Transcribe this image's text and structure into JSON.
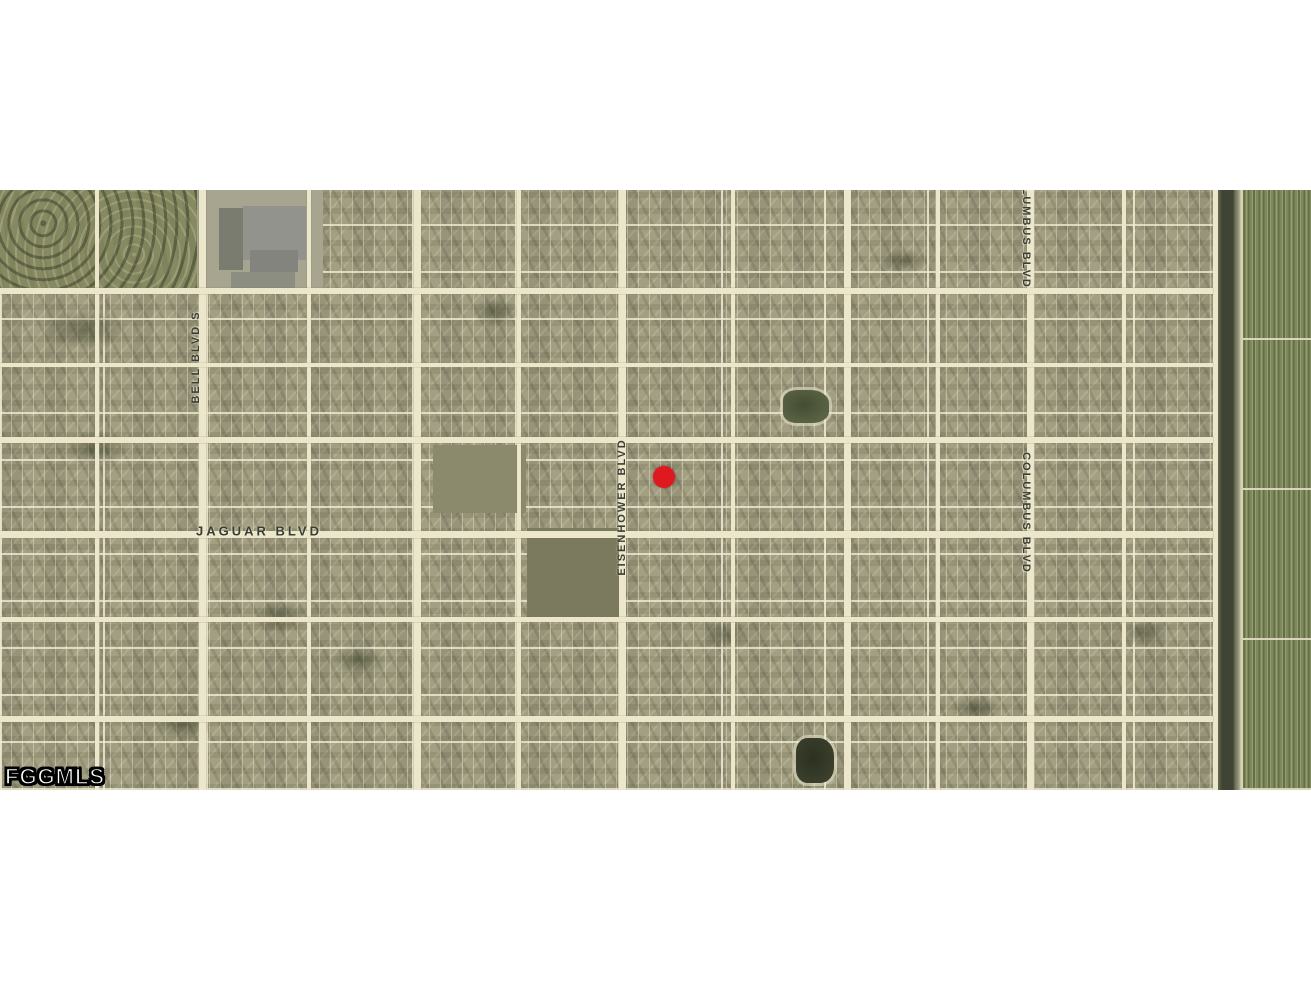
{
  "watermark": {
    "text": "FGGMLS",
    "x": 5,
    "y": 574
  },
  "marker": {
    "x": 664,
    "y": 287,
    "diameter": 22,
    "color": "#de1a20"
  },
  "map": {
    "top": 190,
    "height": 600,
    "width": 1311,
    "colors": {
      "base": "#a39f83",
      "road": "#ece7cb",
      "label": "#3b3d30",
      "canal_water": "#3f4433",
      "farmland": "#7e8a5b"
    },
    "street_labels": [
      {
        "text": "BELL BLVD S",
        "x": 196,
        "y": 167,
        "orientation": "vertical-up"
      },
      {
        "text": "JAGUAR BLVD",
        "x": 259,
        "y": 341,
        "orientation": "horizontal"
      },
      {
        "text": "EISENHOWER BLVD",
        "x": 622,
        "y": 317,
        "orientation": "vertical-up"
      },
      {
        "text": "COLUMBUS BLVD",
        "x": 1026,
        "y": 38,
        "orientation": "vertical-down"
      },
      {
        "text": "COLUMBUS BLVD",
        "x": 1026,
        "y": 323,
        "orientation": "vertical-down"
      }
    ],
    "vertical_roads": [
      {
        "x": 199,
        "w": 7
      },
      {
        "x": 414,
        "w": 7
      },
      {
        "x": 619,
        "w": 7
      },
      {
        "x": 844,
        "w": 7
      },
      {
        "x": 1027,
        "w": 7
      },
      {
        "x": 1213,
        "w": 5
      },
      {
        "x": 95,
        "w": 4
      },
      {
        "x": 307,
        "w": 4
      },
      {
        "x": 517,
        "w": 4
      },
      {
        "x": 731,
        "w": 4
      },
      {
        "x": 936,
        "w": 4
      },
      {
        "x": 1122,
        "w": 4
      }
    ],
    "horizontal_roads": [
      {
        "y": 98,
        "w": 6
      },
      {
        "y": 173,
        "w": 4
      },
      {
        "y": 247,
        "w": 6
      },
      {
        "y": 341,
        "w": 7
      },
      {
        "y": 427,
        "w": 5
      },
      {
        "y": 526,
        "w": 6
      }
    ],
    "areas": [
      {
        "name": "nature-preserve",
        "kind": "nature",
        "x": 0,
        "y": 0,
        "w": 197,
        "h": 104
      },
      {
        "name": "school-site",
        "kind": "plain",
        "x": 197,
        "y": 0,
        "w": 126,
        "h": 100,
        "color": "#a7a48f"
      },
      {
        "name": "school-parking",
        "kind": "plain",
        "x": 219,
        "y": 18,
        "w": 24,
        "h": 62,
        "color": "#797c6e"
      },
      {
        "name": "school-building",
        "kind": "plain",
        "x": 243,
        "y": 16,
        "w": 63,
        "h": 54,
        "color": "#92938d"
      },
      {
        "name": "school-building-annex",
        "kind": "plain",
        "x": 250,
        "y": 60,
        "w": 48,
        "h": 22,
        "color": "#83847d"
      },
      {
        "name": "school-yard",
        "kind": "plain",
        "x": 231,
        "y": 82,
        "w": 64,
        "h": 22,
        "color": "#8d8e82"
      },
      {
        "name": "vacant-parcel",
        "kind": "plain",
        "x": 433,
        "y": 255,
        "w": 93,
        "h": 68,
        "color": "#8b8a6c"
      },
      {
        "name": "vacant-parcel",
        "kind": "plain",
        "x": 527,
        "y": 338,
        "w": 96,
        "h": 93,
        "color": "#7b7a5e"
      },
      {
        "name": "pond",
        "kind": "pond",
        "x": 783,
        "y": 200,
        "w": 46,
        "h": 33,
        "color": "#5a6444"
      },
      {
        "name": "pond",
        "kind": "pond",
        "x": 796,
        "y": 548,
        "w": 38,
        "h": 45,
        "color": "#3a402c"
      },
      {
        "name": "canal",
        "kind": "canal",
        "x": 1213,
        "y": 0,
        "w": 30,
        "h": 600
      },
      {
        "name": "farm-fields",
        "kind": "farmland",
        "x": 1243,
        "y": 0,
        "w": 68,
        "h": 600
      }
    ],
    "vegetation_patches": [
      {
        "x": 40,
        "y": 120,
        "w": 90,
        "h": 40
      },
      {
        "x": 60,
        "y": 240,
        "w": 70,
        "h": 36
      },
      {
        "x": 150,
        "y": 520,
        "w": 64,
        "h": 30
      },
      {
        "x": 250,
        "y": 410,
        "w": 60,
        "h": 34
      },
      {
        "x": 330,
        "y": 455,
        "w": 56,
        "h": 30
      },
      {
        "x": 470,
        "y": 108,
        "w": 50,
        "h": 28
      },
      {
        "x": 700,
        "y": 430,
        "w": 52,
        "h": 30
      },
      {
        "x": 880,
        "y": 58,
        "w": 48,
        "h": 26
      },
      {
        "x": 950,
        "y": 505,
        "w": 52,
        "h": 28
      },
      {
        "x": 1120,
        "y": 430,
        "w": 46,
        "h": 26
      }
    ]
  }
}
